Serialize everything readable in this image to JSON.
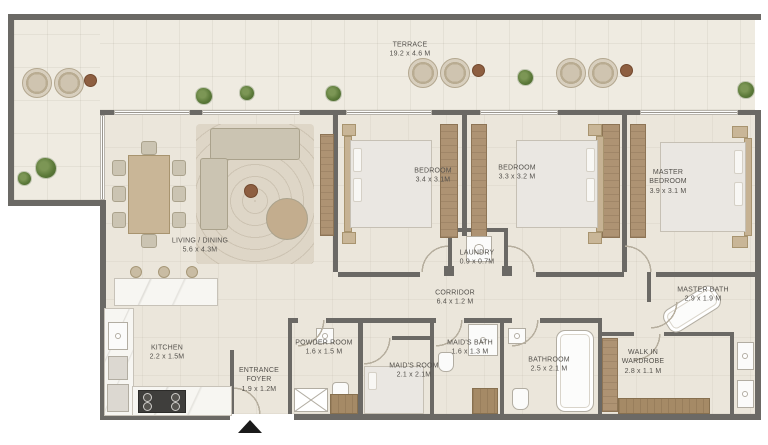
{
  "rooms": [
    {
      "name": "TERRACE",
      "dims": "19.2 x 4.6 M"
    },
    {
      "name": "LIVING / DINING",
      "dims": "5.6 x 4.3M"
    },
    {
      "name": "BEDROOM",
      "dims": "3.4 x 3.1M"
    },
    {
      "name": "BEDROOM",
      "dims": "3.3 x 3.2 M"
    },
    {
      "name": "MASTER BEDROOM",
      "dims": "3.9 x 3.1 M"
    },
    {
      "name": "LAUNDRY",
      "dims": "0.9 x 0.7M"
    },
    {
      "name": "CORRIDOR",
      "dims": "6.4 x 1.2 M"
    },
    {
      "name": "MASTER BATH",
      "dims": "2.9 x 1.9 M"
    },
    {
      "name": "KITCHEN",
      "dims": "2.2 x 1.5M"
    },
    {
      "name": "ENTRANCE FOYER",
      "dims": "1.9 x 1.2M"
    },
    {
      "name": "POWDER ROOM",
      "dims": "1.6 x 1.5 M"
    },
    {
      "name": "MAID'S ROOM",
      "dims": "2.1 x 2.1M"
    },
    {
      "name": "MAID'S BATH",
      "dims": "1.6 x 1.3 M"
    },
    {
      "name": "BATHROOM",
      "dims": "2.5 x 2.1 M"
    },
    {
      "name": "WALK IN WARDROBE",
      "dims": "2.8 x 1.1 M"
    }
  ],
  "markers": {
    "entrance_direction": "up"
  },
  "colors": {
    "wall": "#6b6965",
    "floor": "#ebe6db",
    "terrace_floor": "#efebe1",
    "wood": "#ae9373",
    "plant": "#5a7838",
    "marble": "#f7f6f2",
    "text": "#54514c",
    "entrance_marker": "#1a1a1a"
  }
}
